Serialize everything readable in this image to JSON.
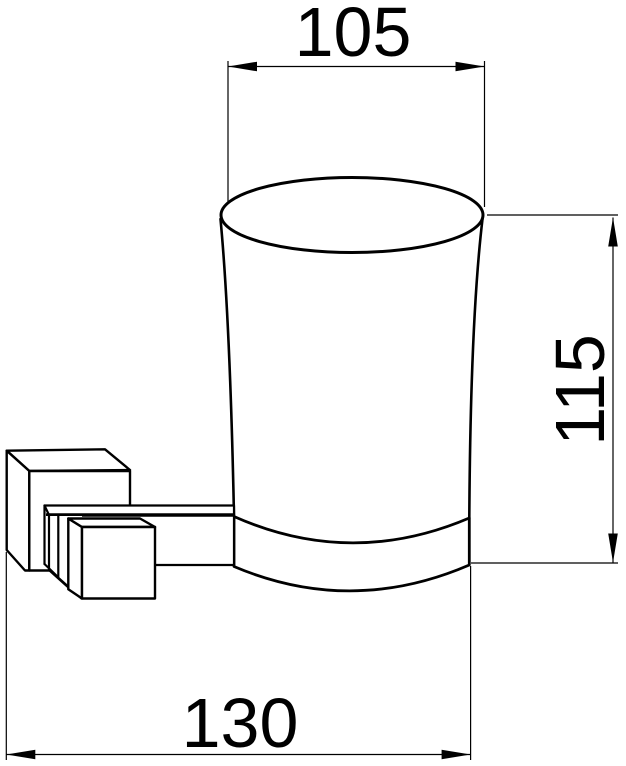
{
  "drawing": {
    "type": "technical-dimension-drawing",
    "subject": "wall-mounted glass tumbler holder side view",
    "dimensions": {
      "top_width": "105",
      "right_height": "115",
      "bottom_width": "130"
    },
    "colors": {
      "line": "#000000",
      "background": "#ffffff"
    }
  }
}
